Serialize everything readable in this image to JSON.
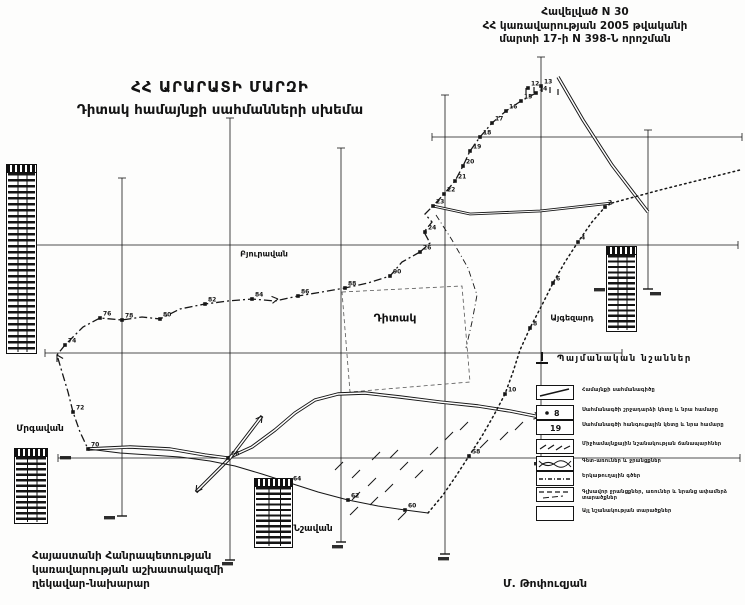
{
  "appendix": {
    "lines": [
      "Հավելված N 30",
      "ՀՀ կառավարության 2005 թվականի",
      "մարտի 17-ի N 398-Ն որոշման"
    ]
  },
  "title": {
    "lines": [
      "ՀՀ ԱՐԱՐԱՏԻ ՄԱՐԶԻ",
      "Դիտակ համայնքի սահմանների սխեմա"
    ]
  },
  "footer": {
    "left_lines": [
      "Հայաստանի Հանրապետության",
      "կառավարության աշխատակազմի",
      "ղեկավար-նախարար"
    ],
    "signature": "Մ. Թոփուզյան"
  },
  "legend": {
    "title": "Պայմանական նշաններ",
    "items": [
      {
        "id": "boundary-line",
        "label": "Համայնքի սահմանագիծը"
      },
      {
        "id": "turn-point",
        "label": "Սահմանագծի շրջադարձի կետը և նրա համարը",
        "symbol_text": "8"
      },
      {
        "id": "node-point",
        "label": "Սահմանագծի հանգուցային կետը և նրա համարը",
        "symbol_text": "19"
      },
      {
        "id": "intercommunity-road",
        "label": "Միջհամայնքային նշանակության ճանապարհներ"
      },
      {
        "id": "rivers-canals",
        "label": "Գետ-առուներ և ջրանցքներ"
      },
      {
        "id": "railway",
        "label": "Երկաթուղային գծեր"
      },
      {
        "id": "main-canal",
        "label": "Գլխավոր ջրանցքներ, առուներ և նրանց ափամերձ տարածքներ"
      },
      {
        "id": "other-lands",
        "label": "Այլ նշանակության տարածքներ"
      }
    ]
  },
  "settlements": [
    {
      "name": "Դիտակ",
      "x": 395,
      "y": 318,
      "size": 11
    },
    {
      "name": "Բյուրավան",
      "x": 264,
      "y": 254,
      "size": 8
    },
    {
      "name": "Մրգավան",
      "x": 40,
      "y": 429,
      "size": 9
    },
    {
      "name": "Նշավան",
      "x": 313,
      "y": 529,
      "size": 9
    },
    {
      "name": "Այգեզարդ",
      "x": 572,
      "y": 318,
      "size": 8
    }
  ],
  "tables": [
    {
      "x": 6,
      "y": 164,
      "w": 31,
      "h": 190,
      "rows": 30
    },
    {
      "x": 606,
      "y": 246,
      "w": 31,
      "h": 86,
      "rows": 14
    },
    {
      "x": 254,
      "y": 478,
      "w": 39,
      "h": 70,
      "rows": 11
    },
    {
      "x": 14,
      "y": 448,
      "w": 34,
      "h": 76,
      "rows": 12
    }
  ],
  "map": {
    "grid": {
      "vertical": [
        {
          "x": 122,
          "y1": 178,
          "y2": 516
        },
        {
          "x": 230,
          "y1": 118,
          "y2": 560
        },
        {
          "x": 341,
          "y1": 148,
          "y2": 542
        },
        {
          "x": 445,
          "y1": 95,
          "y2": 554
        },
        {
          "x": 541,
          "y1": 57,
          "y2": 460
        },
        {
          "x": 648,
          "y1": 130,
          "y2": 289
        }
      ],
      "horizontal": [
        {
          "y": 137,
          "x1": 432,
          "x2": 742
        },
        {
          "y": 245,
          "x1": 8,
          "x2": 738
        },
        {
          "y": 353,
          "x1": 45,
          "x2": 622
        },
        {
          "y": 458,
          "x1": 58,
          "x2": 740
        }
      ]
    },
    "boundaries": [
      {
        "name": "northwest",
        "style": "dashdot",
        "points": [
          [
            536,
            93
          ],
          [
            521,
            101
          ],
          [
            506,
            111
          ],
          [
            492,
            123
          ],
          [
            480,
            137
          ],
          [
            470,
            151
          ],
          [
            463,
            166
          ],
          [
            455,
            181
          ],
          [
            444,
            194
          ],
          [
            433,
            206
          ],
          [
            425,
            214
          ],
          [
            432,
            222
          ],
          [
            424,
            232
          ],
          [
            430,
            243
          ],
          [
            420,
            252
          ]
        ]
      },
      {
        "name": "west-chain",
        "style": "dashdot",
        "points": [
          [
            420,
            252
          ],
          [
            402,
            262
          ],
          [
            390,
            276
          ],
          [
            368,
            283
          ],
          [
            345,
            288
          ],
          [
            322,
            292
          ],
          [
            298,
            296
          ],
          [
            275,
            301
          ],
          [
            252,
            299
          ],
          [
            228,
            301
          ],
          [
            205,
            304
          ],
          [
            180,
            309
          ],
          [
            160,
            319
          ],
          [
            142,
            317
          ],
          [
            122,
            320
          ],
          [
            100,
            318
          ],
          [
            83,
            327
          ],
          [
            65,
            345
          ]
        ]
      },
      {
        "name": "left-side",
        "style": "dashdot",
        "points": [
          [
            65,
            345
          ],
          [
            57,
            355
          ],
          [
            62,
            372
          ],
          [
            68,
            392
          ],
          [
            73,
            412
          ],
          [
            80,
            432
          ],
          [
            88,
            449
          ]
        ]
      },
      {
        "name": "south",
        "style": "solidthin",
        "points": [
          [
            88,
            449
          ],
          [
            120,
            453
          ],
          [
            150,
            455
          ],
          [
            180,
            457
          ],
          [
            210,
            461
          ],
          [
            235,
            466
          ],
          [
            262,
            474
          ],
          [
            290,
            483
          ],
          [
            318,
            492
          ],
          [
            348,
            500
          ],
          [
            378,
            506
          ],
          [
            405,
            510
          ],
          [
            428,
            513
          ]
        ]
      },
      {
        "name": "southeast-dotted",
        "style": "dotted",
        "points": [
          [
            428,
            513
          ],
          [
            443,
            495
          ],
          [
            456,
            476
          ],
          [
            469,
            456
          ],
          [
            482,
            436
          ],
          [
            494,
            415
          ],
          [
            505,
            394
          ],
          [
            513,
            372
          ],
          [
            520,
            350
          ],
          [
            530,
            328
          ],
          [
            542,
            305
          ],
          [
            553,
            283
          ],
          [
            565,
            262
          ],
          [
            578,
            242
          ],
          [
            592,
            222
          ],
          [
            605,
            207
          ],
          [
            612,
            203
          ]
        ]
      },
      {
        "name": "northeast-top",
        "style": "double",
        "points": [
          [
            433,
            206
          ],
          [
            470,
            214
          ],
          [
            540,
            211
          ],
          [
            612,
            203
          ]
        ]
      },
      {
        "name": "ne-dotted-ext",
        "style": "dotted",
        "points": [
          [
            612,
            203
          ],
          [
            660,
            190
          ],
          [
            700,
            180
          ],
          [
            740,
            170
          ]
        ]
      }
    ],
    "roads": [
      {
        "name": "main-road",
        "points": [
          [
            88,
            449
          ],
          [
            130,
            447
          ],
          [
            170,
            449
          ],
          [
            205,
            455
          ],
          [
            228,
            458
          ],
          [
            252,
            447
          ],
          [
            275,
            430
          ],
          [
            295,
            413
          ],
          [
            315,
            400
          ],
          [
            338,
            394
          ],
          [
            365,
            393
          ],
          [
            400,
            397
          ],
          [
            440,
            402
          ],
          [
            478,
            406
          ],
          [
            510,
            411
          ],
          [
            540,
            417
          ]
        ]
      },
      {
        "name": "cross-road",
        "points": [
          [
            196,
            492
          ],
          [
            230,
            458
          ],
          [
            262,
            416
          ]
        ]
      },
      {
        "name": "ne-road",
        "points": [
          [
            558,
            77
          ],
          [
            583,
            120
          ],
          [
            612,
            165
          ],
          [
            648,
            212
          ]
        ]
      }
    ],
    "canals": [
      {
        "points": [
          [
            436,
            215
          ],
          [
            452,
            240
          ],
          [
            468,
            268
          ],
          [
            477,
            295
          ],
          [
            472,
            322
          ],
          [
            466,
            348
          ]
        ]
      }
    ],
    "village_area": {
      "points": [
        [
          342,
          292
        ],
        [
          462,
          286
        ],
        [
          470,
          382
        ],
        [
          350,
          392
        ]
      ]
    },
    "hatches": [
      [
        335,
        470
      ],
      [
        352,
        478
      ],
      [
        368,
        486
      ],
      [
        385,
        492
      ],
      [
        400,
        470
      ],
      [
        415,
        478
      ],
      [
        372,
        460
      ],
      [
        390,
        458
      ],
      [
        352,
        500
      ],
      [
        370,
        505
      ],
      [
        430,
        455
      ],
      [
        445,
        440
      ],
      [
        460,
        430
      ],
      [
        480,
        448
      ],
      [
        500,
        440
      ],
      [
        515,
        430
      ],
      [
        350,
        515
      ],
      [
        398,
        520
      ]
    ],
    "apex_ticks": [
      [
        526,
        88
      ],
      [
        534,
        87
      ],
      [
        542,
        86
      ],
      [
        550,
        87
      ],
      [
        558,
        89
      ]
    ],
    "points": [
      {
        "n": "12",
        "x": 528,
        "y": 88
      },
      {
        "n": "13",
        "x": 541,
        "y": 86
      },
      {
        "n": "14",
        "x": 536,
        "y": 93
      },
      {
        "n": "15",
        "x": 521,
        "y": 101
      },
      {
        "n": "16",
        "x": 506,
        "y": 111
      },
      {
        "n": "17",
        "x": 492,
        "y": 123
      },
      {
        "n": "18",
        "x": 480,
        "y": 137
      },
      {
        "n": "19",
        "x": 470,
        "y": 151
      },
      {
        "n": "20",
        "x": 463,
        "y": 166
      },
      {
        "n": "21",
        "x": 455,
        "y": 181
      },
      {
        "n": "22",
        "x": 444,
        "y": 194
      },
      {
        "n": "23",
        "x": 433,
        "y": 206
      },
      {
        "n": "24",
        "x": 425,
        "y": 232
      },
      {
        "n": "26",
        "x": 420,
        "y": 252
      },
      {
        "n": "90",
        "x": 390,
        "y": 276
      },
      {
        "n": "88",
        "x": 345,
        "y": 288
      },
      {
        "n": "86",
        "x": 298,
        "y": 296
      },
      {
        "n": "84",
        "x": 252,
        "y": 299
      },
      {
        "n": "82",
        "x": 205,
        "y": 304
      },
      {
        "n": "80",
        "x": 160,
        "y": 319
      },
      {
        "n": "78",
        "x": 122,
        "y": 320
      },
      {
        "n": "76",
        "x": 100,
        "y": 318
      },
      {
        "n": "74",
        "x": 65,
        "y": 345
      },
      {
        "n": "72",
        "x": 73,
        "y": 412
      },
      {
        "n": "70",
        "x": 88,
        "y": 449
      },
      {
        "n": "66",
        "x": 228,
        "y": 458
      },
      {
        "n": "64",
        "x": 290,
        "y": 483
      },
      {
        "n": "62",
        "x": 348,
        "y": 500
      },
      {
        "n": "60",
        "x": 405,
        "y": 510
      },
      {
        "n": "2",
        "x": 605,
        "y": 207
      },
      {
        "n": "4",
        "x": 578,
        "y": 242
      },
      {
        "n": "6",
        "x": 553,
        "y": 283
      },
      {
        "n": "8",
        "x": 530,
        "y": 328
      },
      {
        "n": "10",
        "x": 505,
        "y": 394
      },
      {
        "n": "58",
        "x": 469,
        "y": 456
      }
    ],
    "smudges": [
      [
        104,
        516
      ],
      [
        222,
        562
      ],
      [
        332,
        545
      ],
      [
        438,
        557
      ],
      [
        534,
        462
      ],
      [
        594,
        288
      ],
      [
        650,
        292
      ],
      [
        60,
        456
      ]
    ],
    "arrows": [
      {
        "x": 540,
        "y": 417,
        "angle": 12
      },
      {
        "x": 262,
        "y": 416,
        "angle": -55
      },
      {
        "x": 196,
        "y": 492,
        "angle": 125
      },
      {
        "x": 278,
        "y": 299,
        "angle": -8
      },
      {
        "x": 57,
        "y": 355,
        "angle": -120
      }
    ]
  },
  "colors": {
    "ink": "#161616",
    "paper": "#fdfdfc"
  }
}
